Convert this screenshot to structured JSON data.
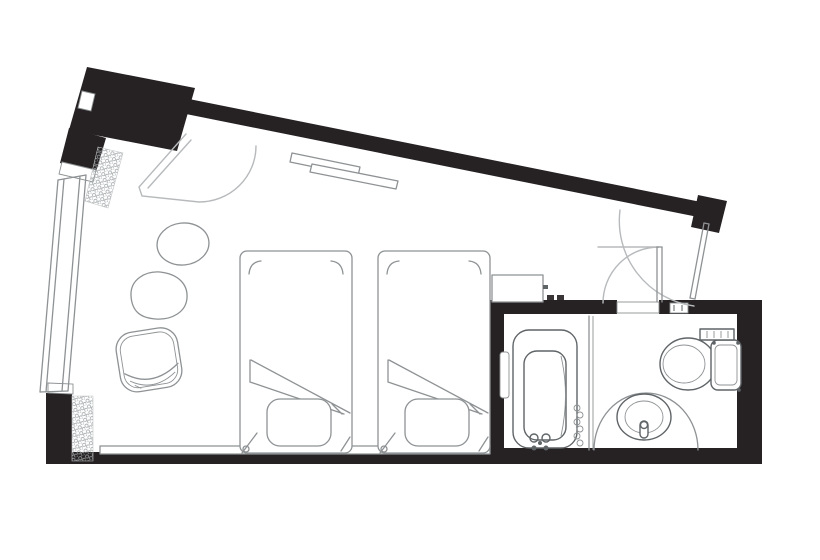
{
  "colors": {
    "background": "#ffffff",
    "wall": "#262223",
    "line": "#8e9294",
    "lineLight": "#b7babc",
    "lineDark": "#5f6467"
  },
  "plan": {
    "type": "hotel-room-floor-plan",
    "elements": [
      "structural-column",
      "corridor-wall",
      "window-wall",
      "curtain-hatch",
      "entrance-door",
      "bathroom-door",
      "twin-bed-1",
      "twin-bed-2",
      "pillow",
      "folded-duvet",
      "headboard-shelf",
      "tv-shelf",
      "round-side-table",
      "coffee-table",
      "armchair",
      "counter-cabinet",
      "bathtub",
      "hand-shower",
      "grab-bar",
      "shower-screen",
      "vanity-counter",
      "wash-basin",
      "basin-faucet",
      "toilet",
      "toilet-control-panel"
    ]
  }
}
